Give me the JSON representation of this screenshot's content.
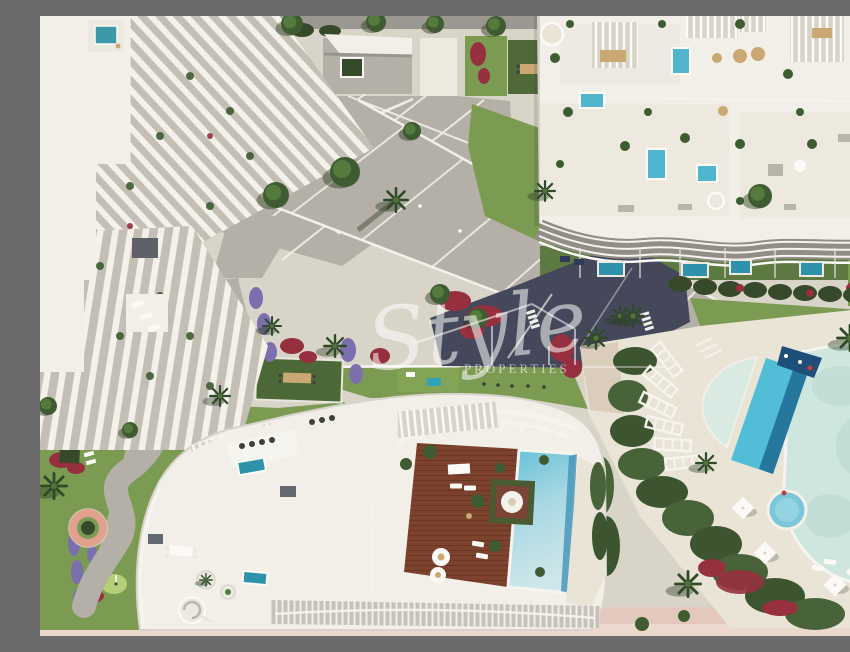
{
  "image": {
    "type": "aerial-architectural-render",
    "subject": "Resort residential complex with curved white apartment buildings, communal lagoon pools, penthouse roof deck and gardens",
    "width_px": 850,
    "height_px": 620
  },
  "watermark": {
    "brand_script": "Style",
    "brand_caps": "PROPERTIES",
    "logo": "house-outline-icon"
  },
  "palette": {
    "canvas_sand": "#d9d4c8",
    "beach_sand": "#e3c9bd",
    "building_white": "#f2efe8",
    "building_shadow": "#c3bfb5",
    "roof_cream": "#eae4d6",
    "paving": "#b4b0a7",
    "street_gray": "#9b9892",
    "road_dark": "#44485a",
    "grass": "#7b9a52",
    "grass_dark": "#5d7a42",
    "hedge_dark": "#36492b",
    "putting_green": "#b4cf77",
    "pool_bright": "#52bdd6",
    "pool_deep": "#1f6b94",
    "pool_teal": "#2e93aa",
    "pool_pale": "#cfe6df",
    "wood_deck": "#7d422e",
    "wood_plank": "#693723",
    "flower_red": "#96303f",
    "flower_purple": "#7b6fae",
    "planter_pink": "#e2a08e",
    "white_line": "#f6f4ee",
    "furniture_tan": "#c9a873",
    "watermark_white": "#ffffff"
  },
  "scene": {
    "labels": [
      "left residential building with fanned white balcony fins",
      "top access street with hedge row",
      "pavilion courtyard with square planter",
      "central paved plaza and diagonal promenade",
      "right residential building with rooftop terraces and plunge pools",
      "row of private garden plunge pools",
      "shaded driveway with crosswalk",
      "communal lagoon pool with island",
      "lap pool with dark water feature",
      "half-moon children's pool",
      "round jacuzzi",
      "fan of sunbed pergolas",
      "penthouse roof with wooden deck and wrap-around pool",
      "fire-pit lounge island with parasol",
      "putting green garden with winding path",
      "pink circular planter",
      "parking bay with cars",
      "beach promenade strip"
    ]
  }
}
